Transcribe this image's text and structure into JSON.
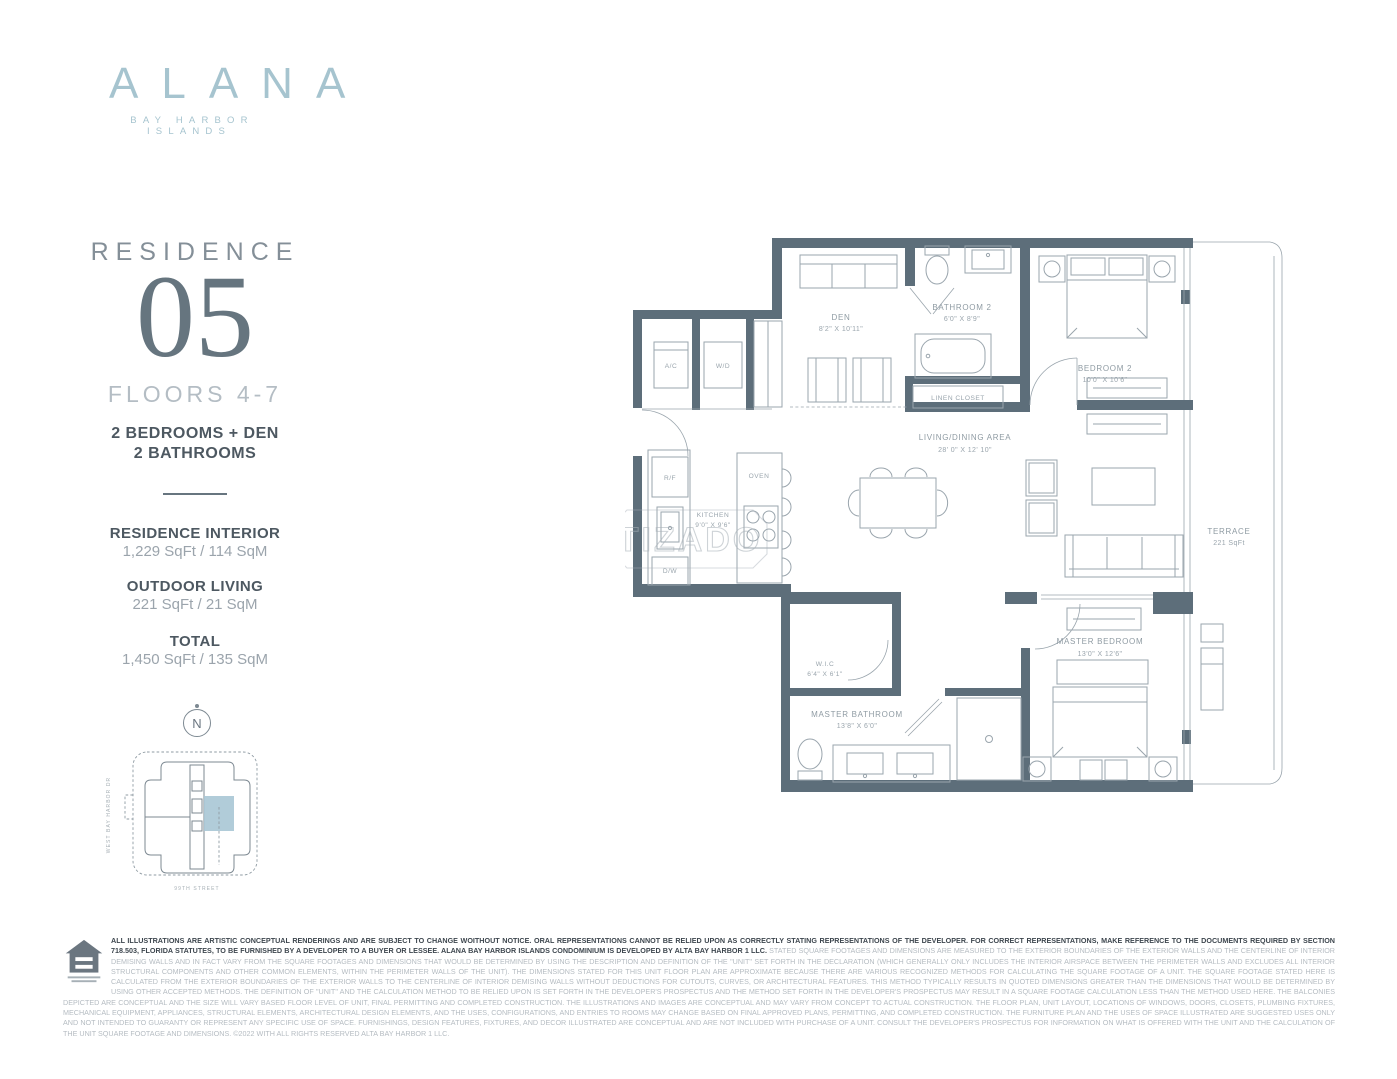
{
  "brand": {
    "name": "ALANA",
    "tagline": "BAY HARBOR ISLANDS",
    "color": "#a6c4cf"
  },
  "residence": {
    "label": "RESIDENCE",
    "number": "05",
    "floors": "FLOORS 4-7",
    "config_line1": "2 BEDROOMS + DEN",
    "config_line2": "2 BATHROOMS",
    "stats": [
      {
        "title": "RESIDENCE INTERIOR",
        "value": "1,229 SqFt / 114 SqM"
      },
      {
        "title": "OUTDOOR LIVING",
        "value": "221 SqFt / 21 SqM"
      },
      {
        "title": "TOTAL",
        "value": "1,450 SqFt / 135 SqM"
      }
    ]
  },
  "keyplan": {
    "north": "N",
    "street_left": "WEST BAY HARBOR DR",
    "street_bottom": "99TH STREET",
    "highlight_color": "#a9c7d5"
  },
  "floorplan": {
    "wall_color": "#5d6e7a",
    "watermark": "TIZADO",
    "rooms": {
      "den": {
        "name": "DEN",
        "dims": "8'2\" X 10'11\""
      },
      "bathroom2": {
        "name": "BATHROOM 2",
        "dims": "6'0\" X 8'9\""
      },
      "linen": {
        "name": "LINEN CLOSET"
      },
      "bedroom2": {
        "name": "BEDROOM 2",
        "dims": "10'0\" X 10'6\""
      },
      "living": {
        "name": "LIVING/DINING AREA",
        "dims": "28' 0\" X 12' 10\""
      },
      "kitchen": {
        "name": "KITCHEN",
        "dims": "9'0\" X 9'6\""
      },
      "oven": {
        "name": "OVEN"
      },
      "ac": {
        "name": "A/C"
      },
      "wd": {
        "name": "W/D"
      },
      "rf": {
        "name": "R/F"
      },
      "dw": {
        "name": "D/W"
      },
      "terrace": {
        "name": "TERRACE",
        "dims": "221 SqFt"
      },
      "wic": {
        "name": "W.I.C",
        "dims": "6'4\" X 6'1\""
      },
      "master_bath": {
        "name": "MASTER BATHROOM",
        "dims": "13'8\" X 6'0\""
      },
      "master_bed": {
        "name": "MASTER BEDROOM",
        "dims": "13'0\" X 12'6\""
      }
    }
  },
  "footer": {
    "logo": "equal-housing-opportunity",
    "disclaimer_bold": "ALL ILLUSTRATIONS ARE ARTISTIC CONCEPTUAL RENDERINGS AND ARE SUBJECT TO CHANGE WOITHOUT NOTICE. ORAL REPRESENTATIONS CANNOT BE RELIED UPON AS CORRECTLY STATING REPRESENTATIONS OF THE DEVELOPER. FOR CORRECT REPRESENTATIONS, MAKE REFERENCE TO THE DOCUMENTS REQUIRED BY SECTION 718.503, FLORIDA STATUTES, TO BE FURNISHED BY A DEVELOPER TO A BUYER OR LESSEE. ALANA BAY HARBOR ISLANDS CONDOMINIUM IS DEVELOPED BY ALTA BAY HARBOR 1 LLC. ",
    "disclaimer_light": "STATED SQUARE FOOTAGES AND DIMENSIONS ARE MEASURED TO THE EXTERIOR BOUNDARIES OF THE EXTERIOR WALLS AND THE CENTERLINE OF INTERIOR DEMISING WALLS AND IN FACT VARY FROM THE SQUARE FOOTAGES AND DIMENSIONS THAT WOULD BE DETERMINED BY USING THE DESCRIPTION AND DEFINITION OF THE \"UNIT\" SET FORTH IN THE DECLARATION (WHICH GENERALLY ONLY INCLUDES THE INTERIOR AIRSPACE BETWEEN THE PERIMETER WALLS AND EXCLUDES ALL INTERIOR STRUCTURAL COMPONENTS AND OTHER COMMON ELEMENTS, WITHIN THE PERIMETER WALLS OF THE UNIT). THE DIMENSIONS STATED FOR THIS UNIT FLOOR PLAN ARE APPROXIMATE BECAUSE THERE ARE VARIOUS RECOGNIZED METHODS FOR CALCULATING THE SQUARE FOOTAGE OF A UNIT. THE SQUARE FOOTAGE STATED HERE IS CALCULATED FROM THE EXTERIOR BOUNDARIES OF THE EXTERIOR WALLS TO THE CENTERLINE OF INTERIOR DEMISING WALLS WITHOUT DEDUCTIONS FOR CUTOUTS, CURVES, OR ARCHITECTURAL FEATURES. THIS METHOD TYPICALLY RESULTS IN QUOTED DIMENSIONS GREATER THAN THE DIMENSIONS THAT WOULD BE DETERMINED BY USING OTHER ACCEPTED METHODS. THE DEFINITION OF \"UNIT\" AND THE CALCULATION METHOD TO BE RELIED UPON IS SET FORTH IN THE DEVELOPER'S PROSPECTUS AND THE METHOD SET FORTH IN THE DEVELOPER'S PROSPECTUS MAY RESULT IN A SQUARE FOOTAGE CALCULATION LESS THAN THE METHOD USED HERE. THE BALCONIES DEPICTED ARE CONCEPTUAL AND THE SIZE WILL VARY BASED FLOOR LEVEL OF UNIT, FINAL PERMITTING AND COMPLETED CONSTRUCTION. THE ILLUSTRATIONS AND IMAGES ARE CONCEPTUAL AND MAY VARY FROM CONCEPT TO ACTUAL CONSTRUCTION. THE FLOOR PLAN, UNIT LAYOUT, LOCATIONS OF WINDOWS, DOORS, CLOSETS, PLUMBING FIXTURES, MECHANICAL EQUIPMENT, APPLIANCES, STRUCTURAL ELEMENTS, ARCHITECTURAL DESIGN ELEMENTS, AND THE USES, CONFIGURATIONS, AND ENTRIES TO ROOMS MAY CHANGE BASED ON FINAL APPROVED PLANS, PERMITTING, AND COMPLETED CONSTRUCTION. THE FURNITURE PLAN AND THE USES OF SPACE ILLUSTRATED ARE SUGGESTED USES ONLY AND NOT INTENDED TO GUARANTY OR REPRESENT ANY SPECIFIC USE OF SPACE. FURNISHINGS, DESIGN FEATURES, FIXTURES, AND DECOR ILLUSTRATED ARE CONCEPTUAL AND ARE NOT INCLUDED WITH PURCHASE OF A UNIT. CONSULT THE DEVELOPER'S PROSPECTUS FOR INFORMATION ON WHAT IS OFFERED WITH THE UNIT AND THE CALCULATION OF THE UNIT SQUARE FOOTAGE AND DIMENSIONS. ©2022 WITH ALL RIGHTS RESERVED ALTA BAY HARBOR 1 LLC."
  }
}
